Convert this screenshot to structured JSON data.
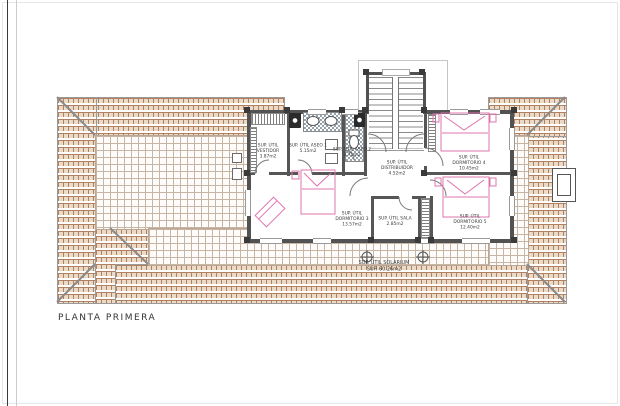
{
  "page": {
    "title": "PLANTA PRIMERA"
  },
  "plan": {
    "type": "architectural-floor-plan",
    "floor": "first floor",
    "rooms": [
      {
        "id": "vestidor",
        "lines": [
          "SUP. ÚTIL",
          "VESTIDOR",
          "3.87m2"
        ]
      },
      {
        "id": "aseo-1",
        "lines": [
          "SUP. ÚTIL ASEO 1",
          "5.15m2"
        ]
      },
      {
        "id": "aseo-2",
        "lines": [
          "SUP. ÚTIL ASEO 2",
          "3.71m2"
        ]
      },
      {
        "id": "distribuidor",
        "lines": [
          "SUP. ÚTIL",
          "DISTRIBUIDOR",
          "4.52m2"
        ]
      },
      {
        "id": "dormitorio-4",
        "lines": [
          "SUP. ÚTIL",
          "DORMITORIO 4",
          "10.45m2"
        ]
      },
      {
        "id": "dormitorio-3",
        "lines": [
          "SUP. ÚTIL",
          "DORMITORIO 3",
          "13.57m2"
        ]
      },
      {
        "id": "sala",
        "lines": [
          "SUP. ÚTIL SALA",
          "2.85m2"
        ]
      },
      {
        "id": "dormitorio-5",
        "lines": [
          "SUP. ÚTIL",
          "DORMITORIO 5",
          "12.40m2"
        ]
      },
      {
        "id": "solarium",
        "lines": [
          "SUP. ÚTIL SOLARIUM",
          "SUP. 60.26m2"
        ]
      }
    ],
    "colors": {
      "roof_tile_line": "#b08060",
      "roof_tile_fill": "#eadbc8",
      "terrace_grid_line": "#c9b5a3",
      "wall": "#525252",
      "furniture_pink": "#df74ad",
      "text": "#3a3a3a"
    }
  }
}
